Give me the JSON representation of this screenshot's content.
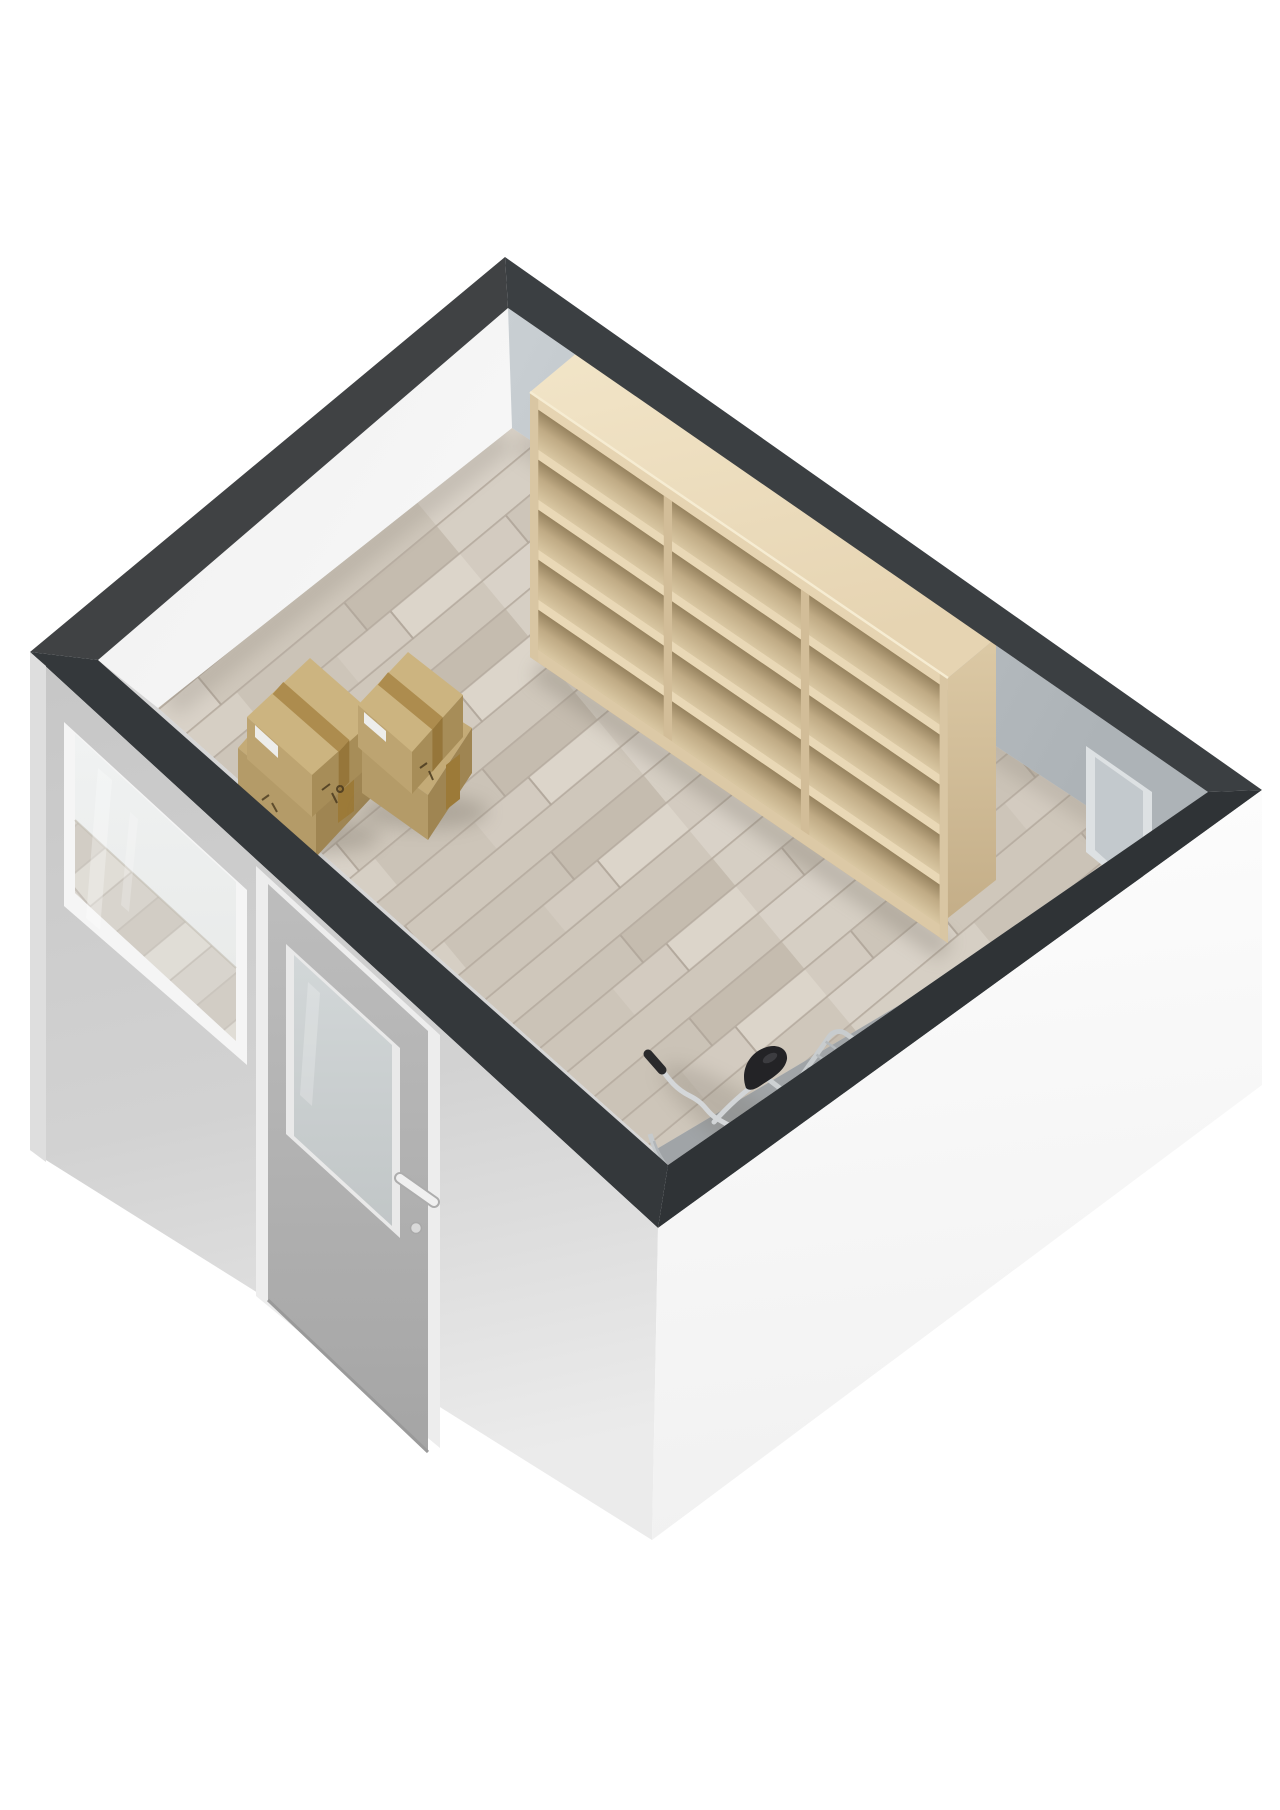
{
  "page": {
    "type": "3d-floorplan-render",
    "background": "#ffffff"
  },
  "room": {
    "label": "storage-room",
    "shape": "rectangular",
    "view": "isometric-top",
    "floor_material": "light-wood-planks"
  },
  "colors": {
    "band": "#3a3d3f",
    "floor": "#d2cabf",
    "floor-joint": "#b8aea2",
    "ext-left-wall": "#c9c9c9",
    "ext-right-wall": "#fbfbfb",
    "int-left-wall": "#f2f2f2",
    "int-right-wall": "#bcc2c6",
    "shelf-wood": "#e3d1b0",
    "box-cardboard": "#bda471",
    "box-tape": "#a8863e",
    "bike-frame": "#d2d5d7",
    "bike-saddle": "#232326",
    "door": "#b6b6b6",
    "door-glass": "#cdd2d3",
    "window-frame": "#f5f5f5"
  },
  "objects": {
    "bookshelf": {
      "label": "bookshelf",
      "position": "back-right-wall",
      "columns": 3,
      "shelves_per_column": 5
    },
    "box_stack_left": {
      "label": "box-stack-left",
      "boxes": 2
    },
    "box_stack_right": {
      "label": "box-stack-right",
      "boxes": 2
    },
    "bicycle": {
      "label": "bicycle",
      "position": "bottom-corner",
      "parts": [
        "handlebar",
        "saddle",
        "rear-rack",
        "wheels"
      ]
    },
    "entry_door": {
      "label": "entry-door",
      "position": "front-left-wall",
      "glass": "frosted",
      "handle": true
    },
    "window": {
      "label": "window",
      "position": "front-left-wall",
      "glass": "clear"
    },
    "interior_door_frame": {
      "label": "interior-door-frame",
      "position": "right-wall"
    }
  }
}
